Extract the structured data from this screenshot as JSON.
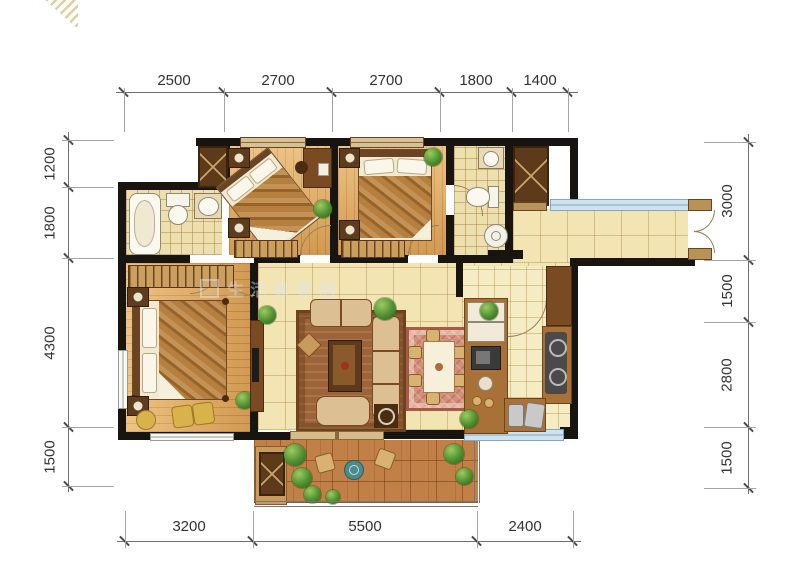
{
  "figure": "residential floor plan drawing",
  "dimensions": {
    "top": [
      "2500",
      "2700",
      "2700",
      "1800",
      "1400"
    ],
    "left": [
      "1200",
      "1800",
      "4300",
      "1500"
    ],
    "right": [
      "3000",
      "1500",
      "2800",
      "1500"
    ],
    "bottom": [
      "3200",
      "5500",
      "2400"
    ]
  },
  "watermark": {
    "brand_text": "生活家家居",
    "corner_logo": "gold-diagonal-stripes"
  },
  "palette": {
    "wall": "#181410",
    "wood_floor": "#e2ab61",
    "tile_floor": "#f3e4b4",
    "bath_tile": "#eedfae",
    "kitchen_tile": "#f6ecc4",
    "balcony_stone": "#c08048",
    "window": "#cfe2ee",
    "cabinet": "#8a5a2b",
    "living_rug": "#9c6438",
    "dining_rug": "#d28f7a",
    "plant": "#4e8f2f",
    "dim_text": "#333333"
  }
}
